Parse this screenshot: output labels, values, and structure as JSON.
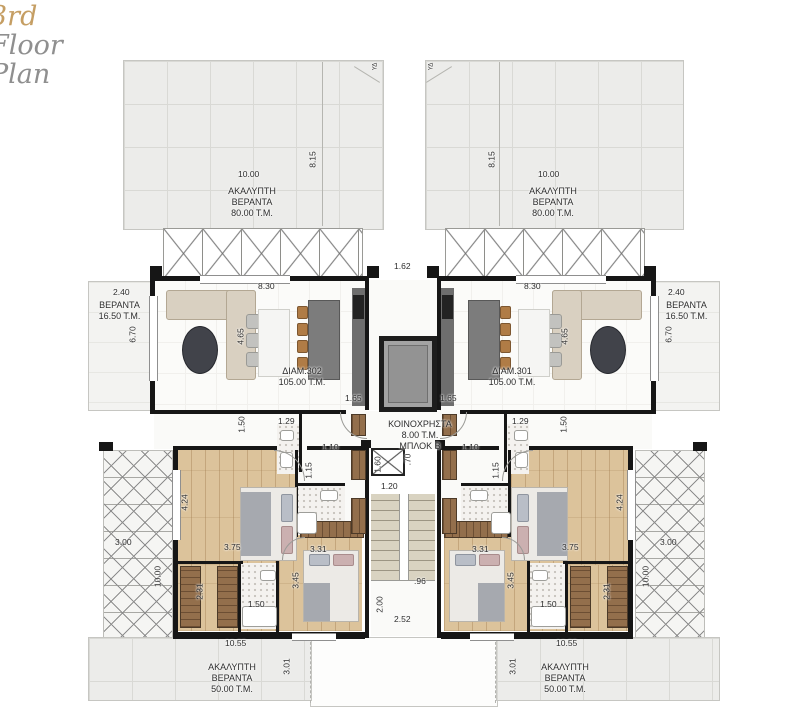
{
  "title": {
    "word1": "3rd",
    "word2": "Floor",
    "word3": "Plan"
  },
  "colors": {
    "accent_gold": "#c59e63",
    "title_gray": "#8f8f8f",
    "wall": "#161616",
    "wood_floor": "#dcc39b",
    "veranda_tile": "#ececea"
  },
  "labels": {
    "veranda_top": [
      "ΑΚΑΛΥΠΤΗ",
      "ΒΕΡΑΝΤΑ",
      "80.00 Τ.Μ."
    ],
    "veranda_bottom": [
      "ΑΚΑΛΥΠΤΗ",
      "ΒΕΡΑΝΤΑ",
      "50.00 Τ.Μ."
    ],
    "veranda_side": [
      "ΒΕΡΑΝΤΑ",
      "16.50 Τ.Μ."
    ],
    "apt_left": [
      "ΔΙΑΜ.302",
      "105.00 Τ.Μ."
    ],
    "apt_right": [
      "ΔΙΑΜ.301",
      "105.00 Τ.Μ."
    ],
    "common": [
      "ΚΟΙΝΟΧΡΗΣΤΑ",
      "8.00 Τ.Μ.",
      "ΜΠΛΟΚ Β"
    ],
    "drain": "ΥΔ"
  },
  "dims": {
    "w1000": "10.00",
    "h815": "8.15",
    "w830": "8.30",
    "gap162": "1.62",
    "w240": "2.40",
    "h670": "6.70",
    "h465": "4.65",
    "w165": "1.65",
    "h150": "1.50",
    "w129": "1.29",
    "w110": "1.10",
    "h115": "1.15",
    "h424": "4.24",
    "w375": "3.75",
    "w331": "3.31",
    "h345": "3.45",
    "h231": "2.31",
    "w150": "1.50",
    "w300": "3.00",
    "v1000": "10.00",
    "w1055": "10.55",
    "h301": "3.01",
    "v70": ".70",
    "v160": "1.60",
    "w120": "1.20",
    "w96": ".96",
    "h200": "2.00",
    "w252": "2.52"
  }
}
